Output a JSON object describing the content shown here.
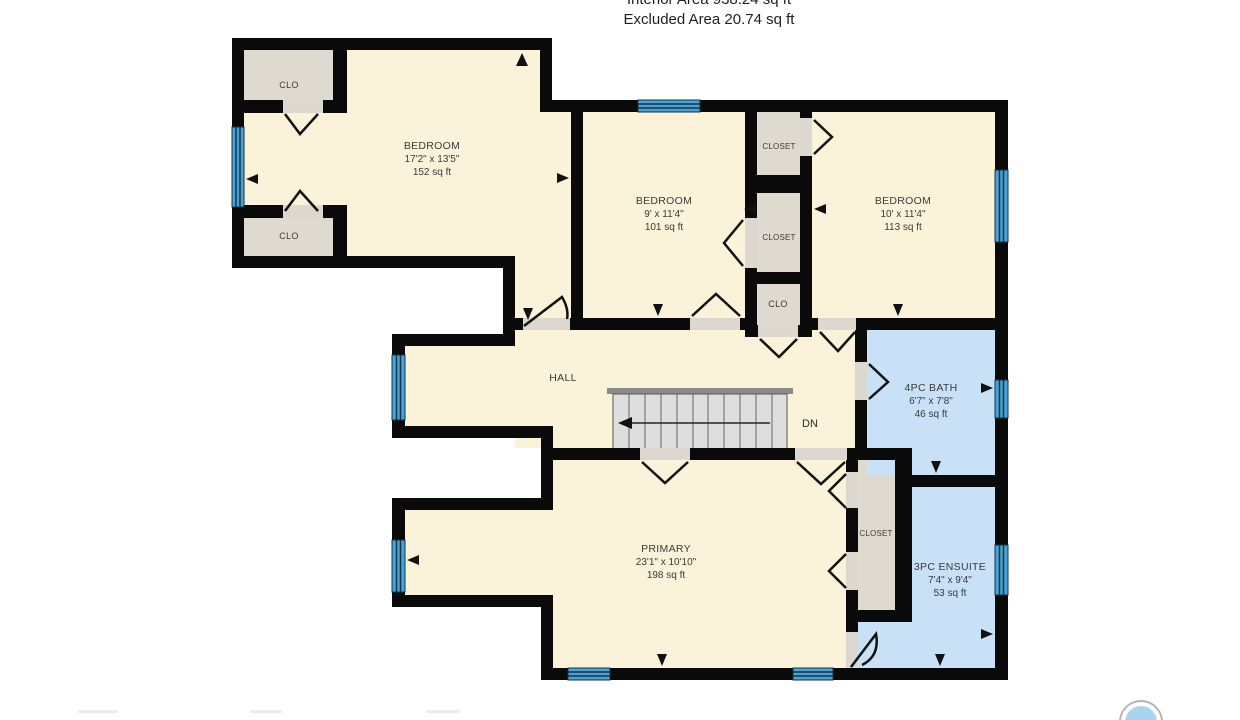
{
  "header": {
    "interior_area": "Interior Area 938.24 sq ft",
    "excluded_area": "Excluded Area 20.74 sq ft"
  },
  "rooms": {
    "bedroom_nw": {
      "name": "BEDROOM",
      "dims": "17'2\" x 13'5\"",
      "area": "152 sq ft"
    },
    "bedroom_mid": {
      "name": "BEDROOM",
      "dims": "9' x 11'4\"",
      "area": "101 sq ft"
    },
    "bedroom_ne": {
      "name": "BEDROOM",
      "dims": "10' x 11'4\"",
      "area": "113 sq ft"
    },
    "bath": {
      "name": "4PC BATH",
      "dims": "6'7\" x 7'8\"",
      "area": "46 sq ft"
    },
    "primary": {
      "name": "PRIMARY",
      "dims": "23'1\" x 10'10\"",
      "area": "198 sq ft"
    },
    "ensuite": {
      "name": "3PC ENSUITE",
      "dims": "7'4\" x 9'4\"",
      "area": "53 sq ft"
    },
    "hall": {
      "name": "HALL"
    }
  },
  "closets": {
    "nw_top": "CLO",
    "nw_bottom": "CLO",
    "mid_top": "CLOSET",
    "mid_middle": "CLOSET",
    "mid_bottom": "CLO",
    "primary_closet": "CLOSET"
  },
  "stairs": {
    "direction": "DN"
  },
  "colors": {
    "wall": "#0a0a0a",
    "room_fill": "#faf3da",
    "closet_fill": "#dfdacf",
    "bath_fill": "#c8e1f6",
    "window_blue": "#4aa3d6",
    "stair_fill": "#dedede",
    "label_text": "#3a3a3a",
    "logo_blue": "#a9d3ee"
  }
}
